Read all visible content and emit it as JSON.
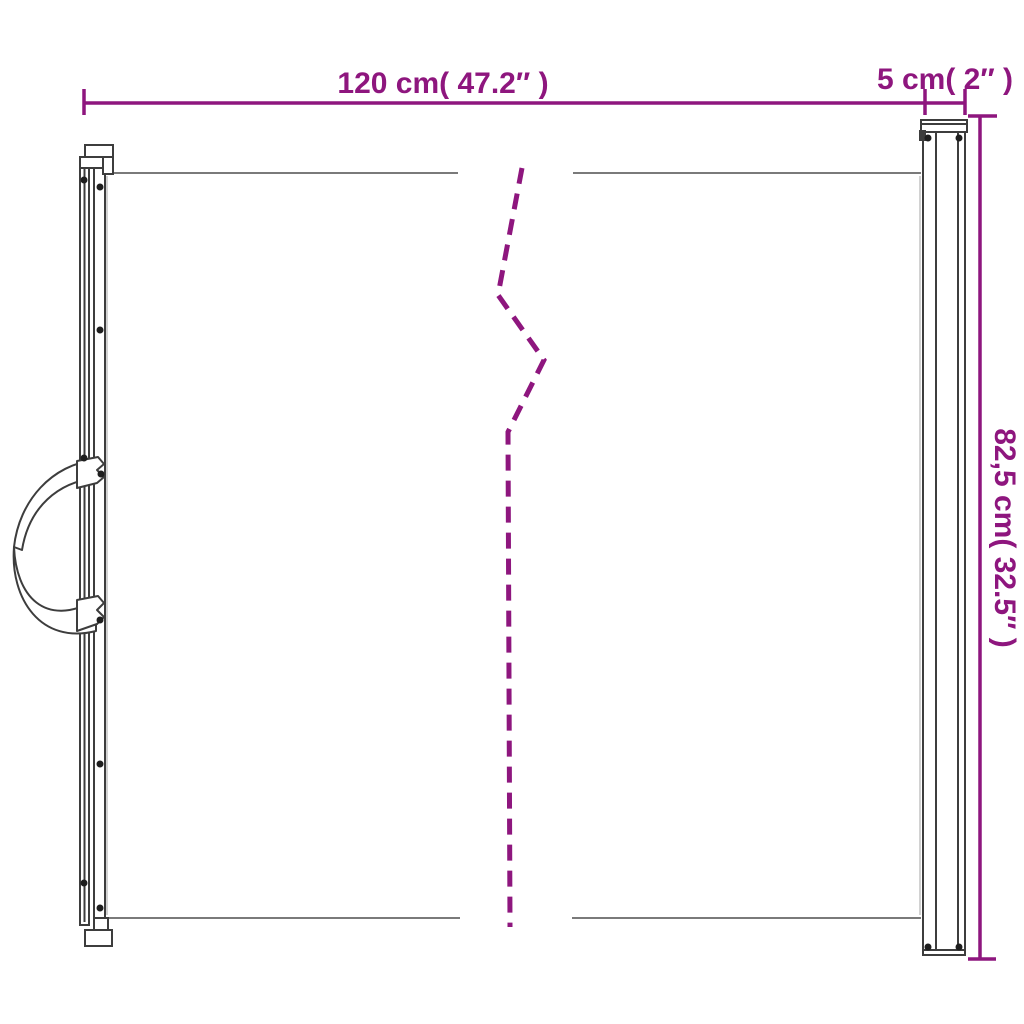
{
  "diagram": {
    "accent_color": "#8e167e",
    "outline_color": "#3d3d3d",
    "mesh_edge_color": "#7a7a7a",
    "faint_edge_color": "#c4c4c4",
    "screw_color": "#1e1e1e",
    "dimensions": {
      "width_label": "120 cm( 47.2″ )",
      "depth_label": "5 cm( 2″ )",
      "height_label": "82,5 cm( 32.5″ )"
    }
  }
}
